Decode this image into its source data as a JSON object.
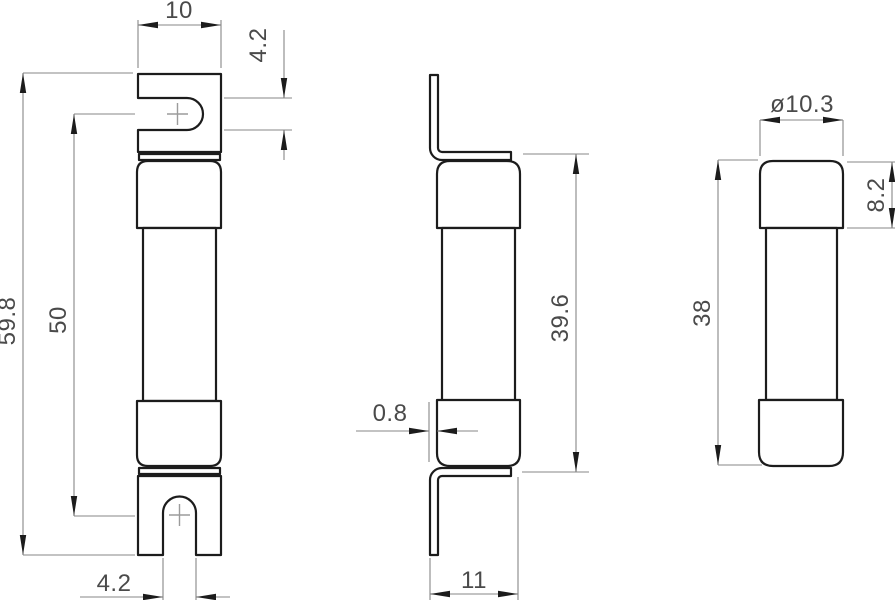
{
  "drawing": {
    "type": "technical-drawing",
    "subject": "fuse with bent blade terminals, three orthographic views",
    "colors": {
      "background": "#ffffff",
      "outline": "#1c1c1c",
      "dimension_lines": "#878787",
      "dimension_text": "#4a4a4a",
      "center_marks": "#9b9b9b"
    },
    "views": {
      "front": {
        "dims": {
          "tab_width": "10",
          "slot_height": "4.2",
          "overall_height": "59.8",
          "slot_center_spacing": "50",
          "slot_width": "4.2"
        }
      },
      "side": {
        "dims": {
          "tab_thickness": "0.8",
          "overall_depth": "11",
          "height_over_tabs": "39.6"
        }
      },
      "cartridge": {
        "dims": {
          "cap_diameter": "ø10.3",
          "cap_height": "8.2",
          "body_height": "38"
        }
      }
    }
  }
}
